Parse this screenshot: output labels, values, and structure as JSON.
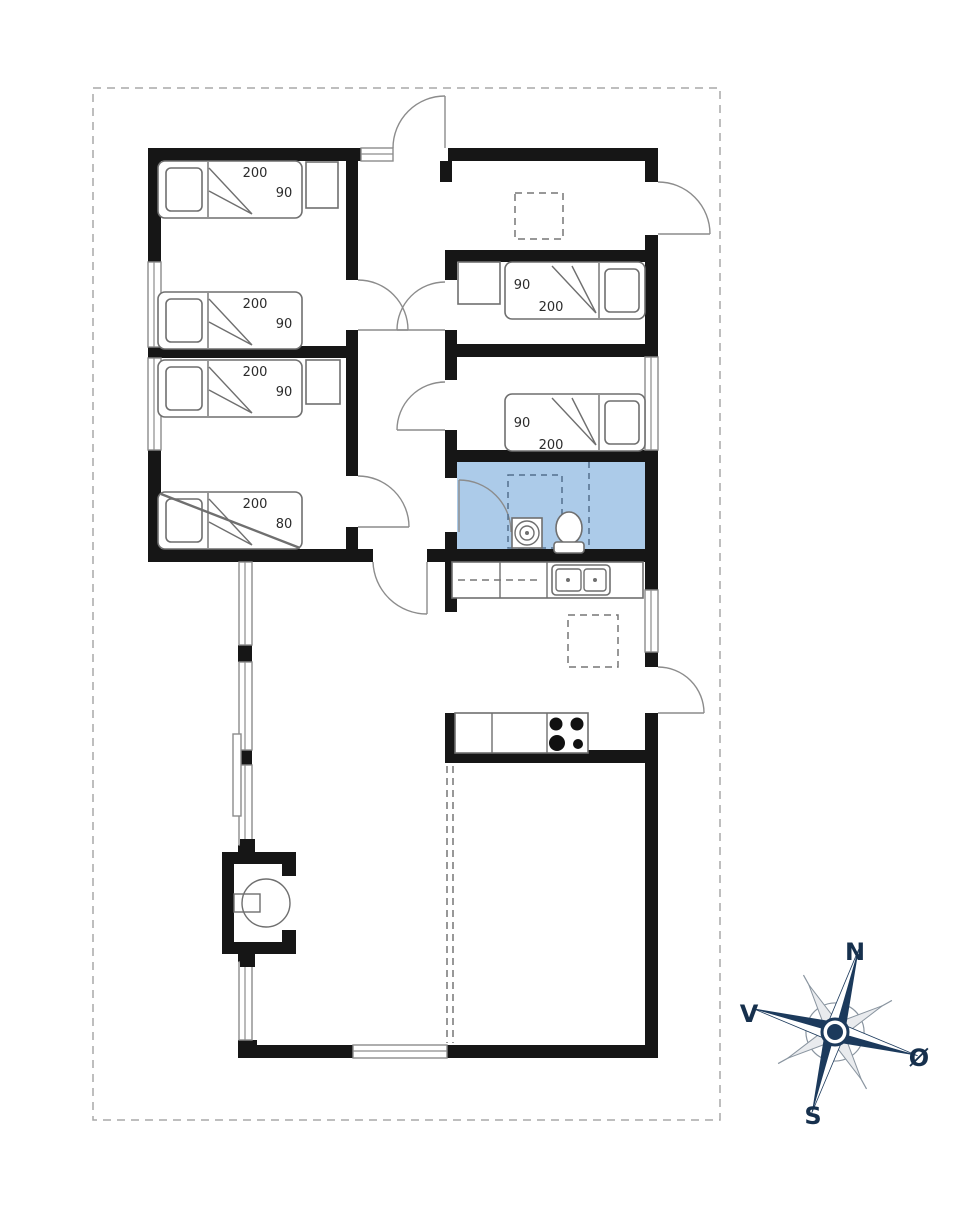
{
  "floor_plan": {
    "beds": [
      {
        "id": "bedroom-nw-bed-upper",
        "length": "200",
        "width": "90"
      },
      {
        "id": "bedroom-nw-bed-lower",
        "length": "200",
        "width": "90"
      },
      {
        "id": "bedroom-w-bed-upper",
        "length": "200",
        "width": "90"
      },
      {
        "id": "bedroom-w-bunk-bed",
        "length": "200",
        "width": "80"
      },
      {
        "id": "bedroom-e-upper-bed",
        "length": "200",
        "width": "90"
      },
      {
        "id": "bedroom-e-lower-bed",
        "length": "200",
        "width": "90"
      }
    ],
    "compass": {
      "north": "N",
      "west": "V",
      "east": "Ø",
      "south": "S"
    },
    "colors": {
      "wall": "#161616",
      "bathroom_fill": "#accbe9",
      "compass_navy": "#1c3a5c",
      "furniture_line": "#6f6f6f",
      "boundary_dash": "#a8a8a8"
    }
  }
}
